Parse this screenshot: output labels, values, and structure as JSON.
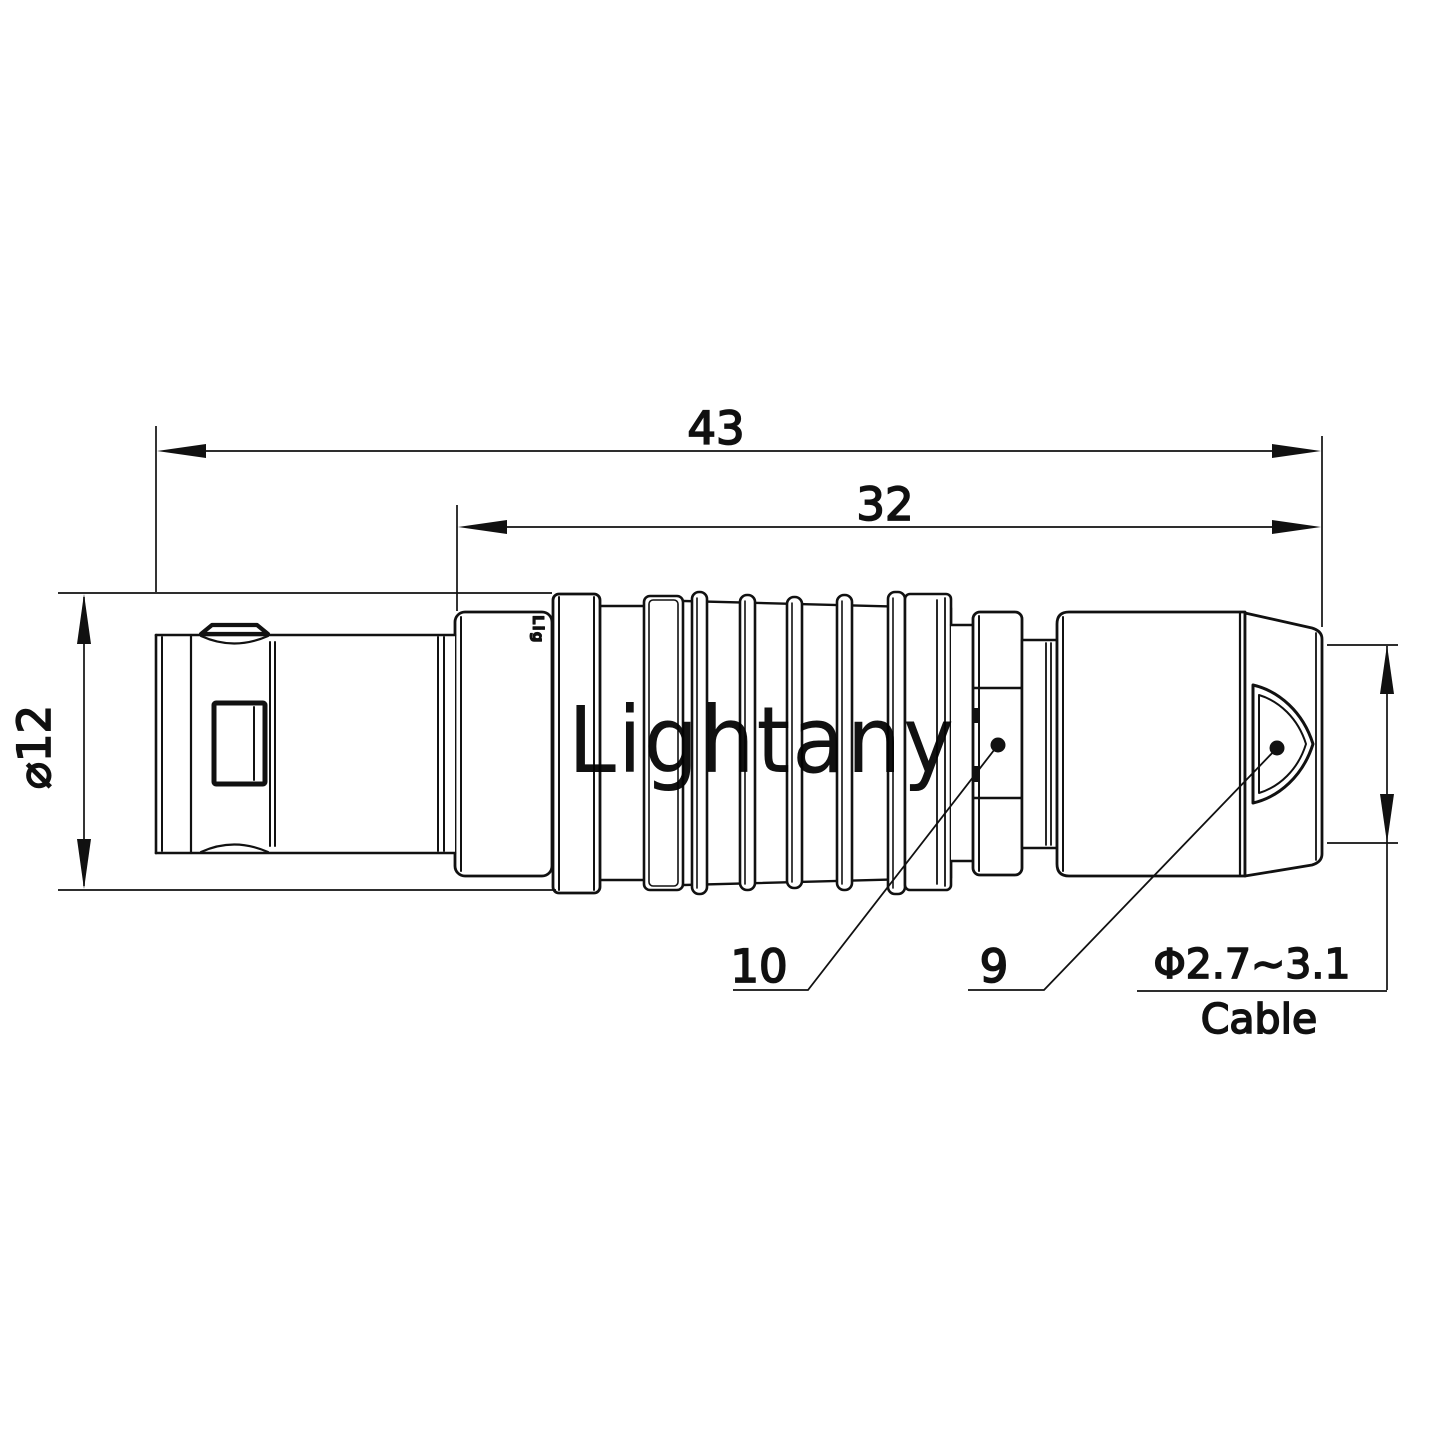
{
  "drawing": {
    "type": "connector-technical-drawing",
    "dimensions": {
      "overall_length": "43",
      "front_length": "32",
      "diameter": "⌀12",
      "cable_range": "Φ2.7~3.1",
      "cable_label": "Cable"
    },
    "callouts": [
      {
        "label": "10"
      },
      {
        "label": "9"
      }
    ],
    "watermark": "Lightany",
    "logo_mark": "Lig",
    "colors": {
      "line": "#111111",
      "watermark_pink": "#f5c9cf",
      "background": "#ffffff"
    }
  }
}
